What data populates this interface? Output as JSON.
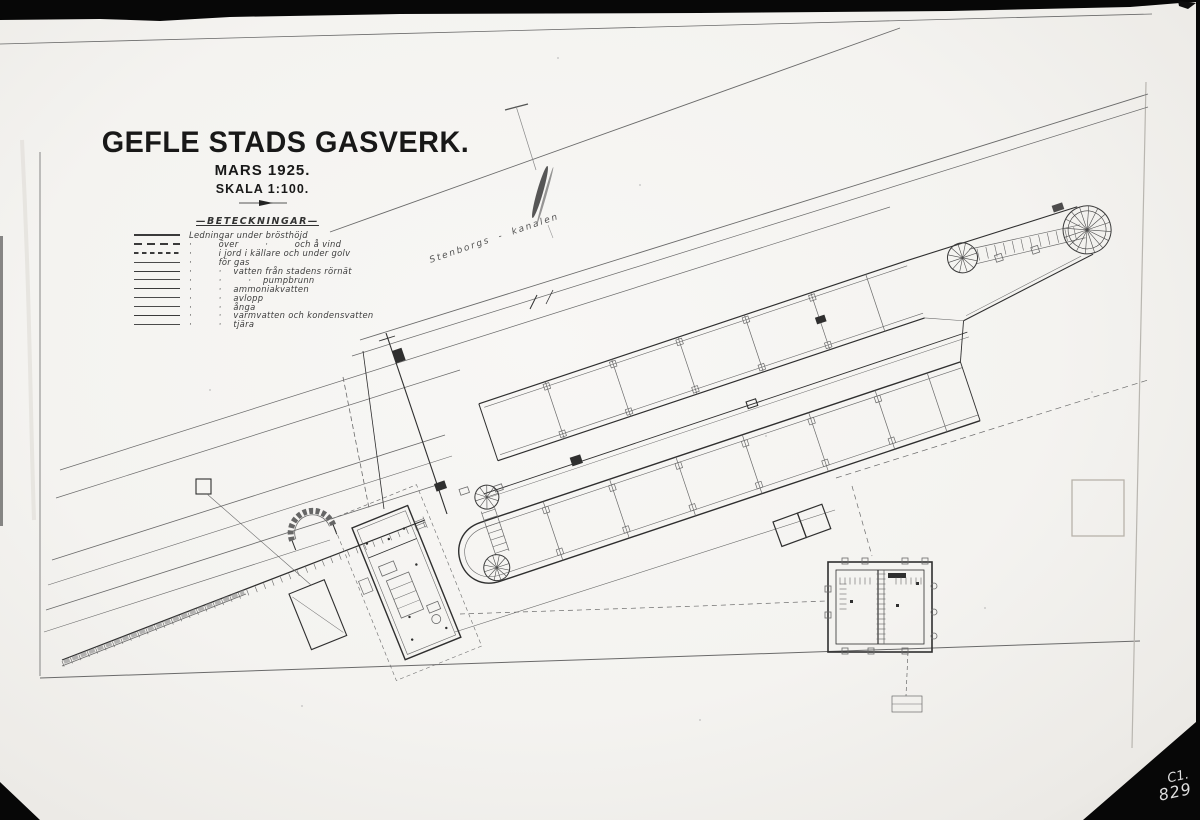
{
  "title_block": {
    "title": "GEFLE STADS GASVERK.",
    "subtitle": "MARS 1925.",
    "scale": "SKALA 1:100."
  },
  "legend": {
    "header": "—BETECKNINGAR—",
    "rows": [
      {
        "sample": "solid",
        "text": "Ledningar under brösthöjd"
      },
      {
        "sample": "dash-long",
        "text": "·         över         ·         och å vind"
      },
      {
        "sample": "dash-short",
        "text": "·         i jord i källare och under golv"
      },
      {
        "sample": "thin",
        "text": "·         för gas"
      },
      {
        "sample": "med",
        "text": "·         ·    vatten från stadens rörnät"
      },
      {
        "sample": "thin",
        "text": "·         ·         ·    pumpbrunn"
      },
      {
        "sample": "med",
        "text": "·         ·    ammoniakvatten"
      },
      {
        "sample": "thin",
        "text": "·         ·    avlopp"
      },
      {
        "sample": "thin",
        "text": "·         ·    ånga"
      },
      {
        "sample": "med",
        "text": "·         ·    varmvatten och kondensvatten"
      },
      {
        "sample": "thin",
        "text": "·         ·    tjära"
      }
    ]
  },
  "map_labels": {
    "canal": "Stenborgs - kanalen"
  },
  "photo": {
    "archive_code_line1": "C1.",
    "archive_code_line2": "829"
  },
  "colors": {
    "paper": "#f4f3f0",
    "ink": "#2f2f2f",
    "ink_soft": "#6a6a6a",
    "photo_bg": "#070707",
    "code_text": "#dedede"
  }
}
